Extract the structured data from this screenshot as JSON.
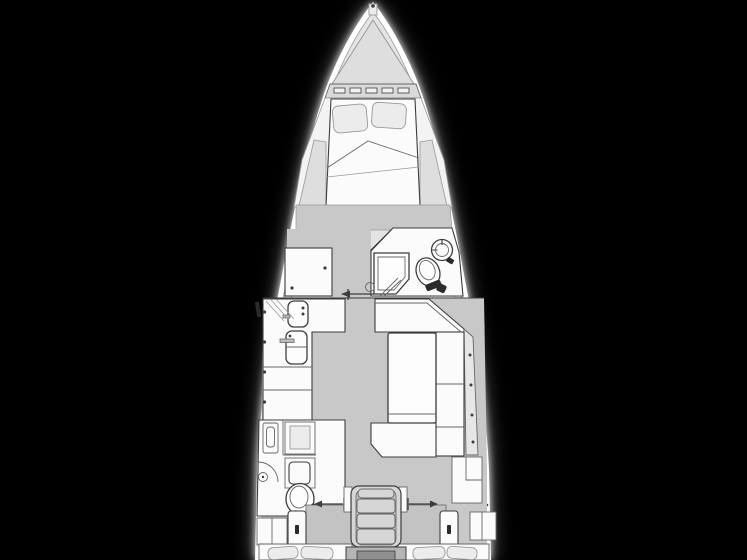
{
  "meta": {
    "description": "Top-down interior floor plan of a sailing yacht, bow pointing up, white line drawing on black background",
    "orientation": "bow-up"
  },
  "canvas": {
    "width": 747,
    "height": 560
  },
  "colors": {
    "bg": "#000000",
    "hull": "#ffffff",
    "deck": "#e4e4e4",
    "bow": "#dedede",
    "band": "#d9d9d9",
    "cabin": "#f3f3f3",
    "floor": "#c8c8c8",
    "floor-dark": "#c3c3c3",
    "furniture": "#fbfbfb",
    "soft": "#ececec",
    "shelf": "#dedede",
    "strip": "#e6e6e6",
    "stairs": "#d6d6d6",
    "stairs-rail": "#bdbdbd",
    "engine": "#b5b5b5",
    "engine-dark": "#8f8f8f",
    "line": "#3d3d3d",
    "line-mid": "#666666",
    "line-soft": "#999999",
    "slot": "#2b2b2b"
  },
  "regions": [
    {
      "id": "hull-outline"
    },
    {
      "id": "side-decks"
    },
    {
      "id": "bow-anchor-locker"
    },
    {
      "id": "foredeck-hatch-band"
    },
    {
      "id": "v-berth-cabin"
    },
    {
      "id": "v-berth-double-bed"
    },
    {
      "id": "v-berth-pillows"
    },
    {
      "id": "forward-wardrobe"
    },
    {
      "id": "forward-head"
    },
    {
      "id": "forward-head-shower"
    },
    {
      "id": "forward-head-toilet"
    },
    {
      "id": "forward-head-washbasin"
    },
    {
      "id": "salon-corridor"
    },
    {
      "id": "galley"
    },
    {
      "id": "galley-sink"
    },
    {
      "id": "galley-stove"
    },
    {
      "id": "salon-table"
    },
    {
      "id": "settee-u-shaped"
    },
    {
      "id": "aft-head"
    },
    {
      "id": "aft-head-toilet"
    },
    {
      "id": "aft-head-shower"
    },
    {
      "id": "companionway-stairs"
    },
    {
      "id": "engine-hatch"
    },
    {
      "id": "aft-cabin-port"
    },
    {
      "id": "aft-cabin-starboard"
    },
    {
      "id": "aft-berth-pillows"
    },
    {
      "id": "door-swing-arrows"
    },
    {
      "id": "hull-window-slots"
    }
  ]
}
